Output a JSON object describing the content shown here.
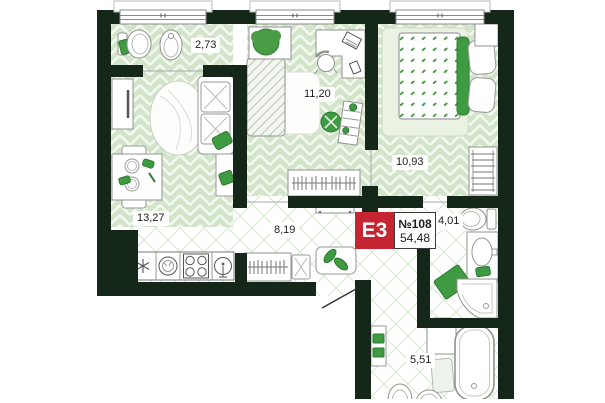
{
  "plan": {
    "badge": {
      "type": "E3",
      "number": "№108",
      "total_area": "54,48"
    },
    "rooms": [
      {
        "id": "bathroom-top",
        "area_label": "2,73"
      },
      {
        "id": "bedroom-middle",
        "area_label": "11,20"
      },
      {
        "id": "bedroom-right",
        "area_label": "10,93"
      },
      {
        "id": "living-kitchen",
        "area_label": "13,27"
      },
      {
        "id": "hallway",
        "area_label": "8,19"
      },
      {
        "id": "bathroom-right",
        "area_label": "4,01"
      },
      {
        "id": "bathroom-bottom",
        "area_label": "5,51"
      }
    ],
    "colors": {
      "wall": "#152718",
      "floor_base": "#d2e4ca",
      "floor_line": "#f4f9f1",
      "hatch_line": "#dcebd6",
      "accent_green": "#3f9b41",
      "badge_red": "#c42531"
    }
  }
}
